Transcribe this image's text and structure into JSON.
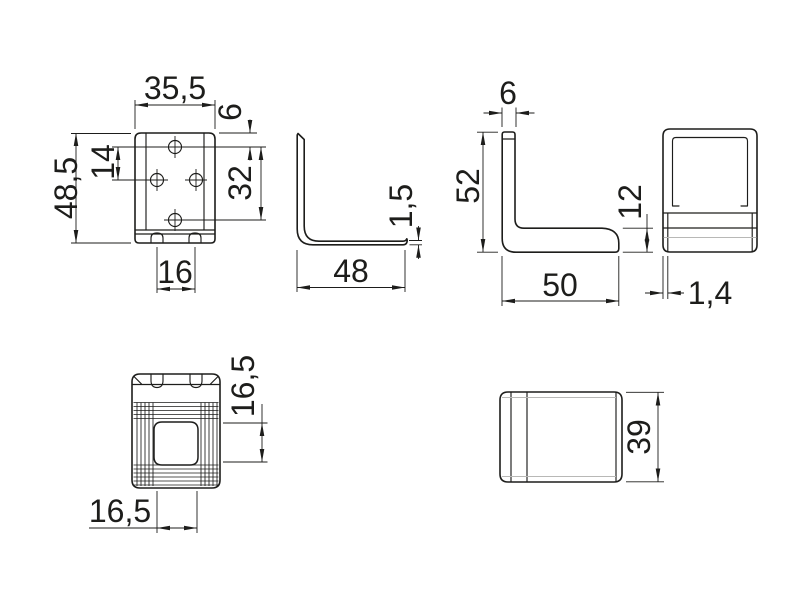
{
  "drawing": {
    "type": "technical-drawing",
    "background": "#ffffff",
    "line_color": "#1d1d1b",
    "light_line_color": "#b8b8b6",
    "views": {
      "front": {
        "label": "bracket-front-view",
        "dims": {
          "width": "35,5",
          "height": "48,5",
          "hole_pitch": "14",
          "top_hole_offset": "6",
          "hole_span": "32",
          "tab_spacing": "16"
        }
      },
      "side_thin": {
        "label": "bracket-side-view",
        "dims": {
          "thickness": "1,5",
          "depth": "48"
        }
      },
      "profile": {
        "label": "bracket-profile-view",
        "dims": {
          "flange": "6",
          "height": "52",
          "lip": "12",
          "length": "50"
        }
      },
      "cover_front": {
        "label": "cover-front-view",
        "dims": {
          "wall": "1,4"
        }
      },
      "plan": {
        "label": "bracket-plan-view",
        "dims": {
          "opening_w": "16,5",
          "opening_h": "16,5"
        }
      },
      "cover_side": {
        "label": "cover-side-view",
        "dims": {
          "height": "39"
        }
      }
    }
  }
}
